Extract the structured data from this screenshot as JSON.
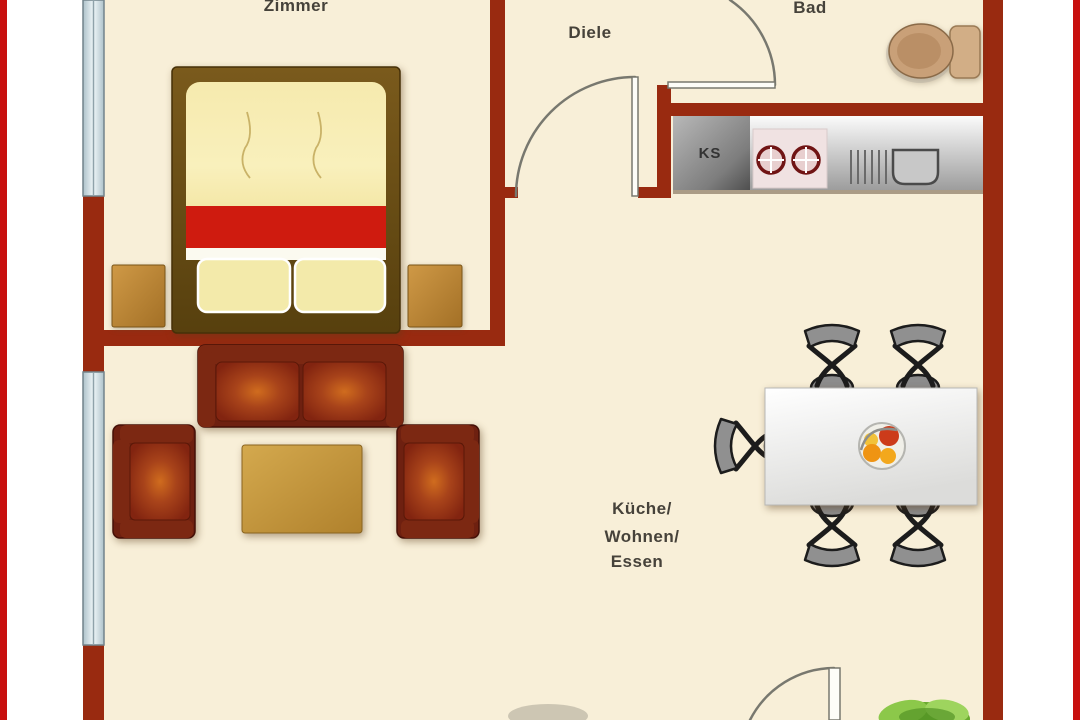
{
  "title": "Apartment floor plan",
  "rooms": {
    "bedroom": {
      "label": "Zimmer"
    },
    "hallway": {
      "label": "Diele"
    },
    "bathroom": {
      "label": "Bad"
    },
    "fridge": {
      "label": "KS"
    },
    "living": {
      "lines": [
        "Küche/",
        "Wohnen/",
        "Essen"
      ]
    }
  },
  "colors": {
    "frame": "#c8100e",
    "margin": "#ffffff",
    "floor": "#f8efd8",
    "wall": "#992a10",
    "window": "#d9e7ec",
    "door_line": "#78786f",
    "bed_frame": "#6e4d16",
    "duvet": "#f5e8a4",
    "bed_stripe": "#cf1b0f",
    "pillow": "#f3eaaa",
    "sofa": "#6e2010",
    "cushion_glow": "#d06c1e",
    "wood": "#c89a3e",
    "counter": "#c0c0c0",
    "chair": "#8c8c8c",
    "dining_table": "#f7f7f5",
    "toilet": "#c9a078",
    "plant": "#7ec240",
    "label_text": "#46423a"
  }
}
